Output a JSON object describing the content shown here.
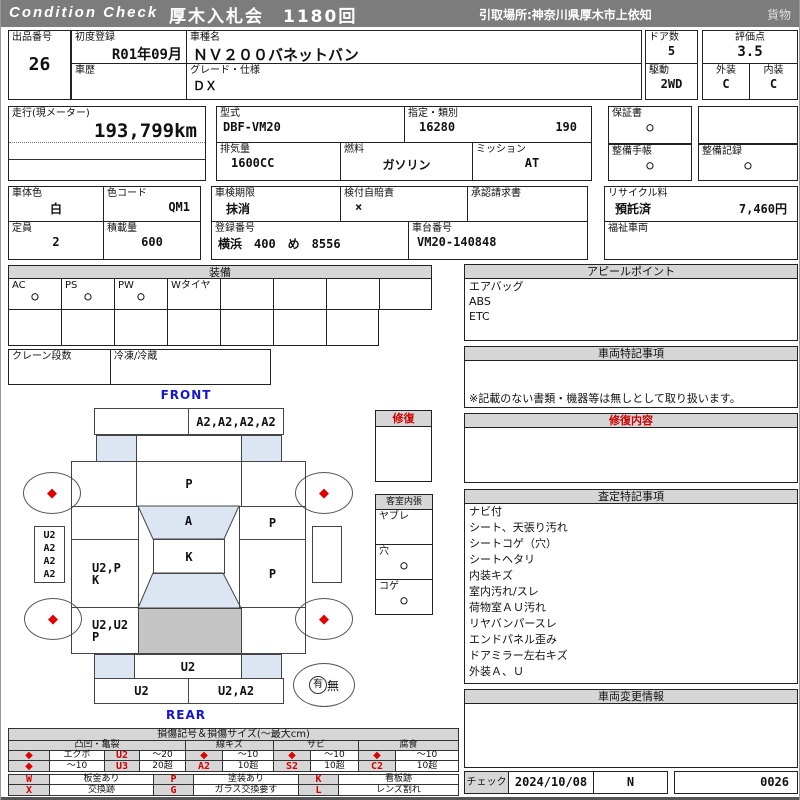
{
  "header": {
    "brand": "Condition Check",
    "title": "厚木入札会　1180回",
    "pickup": "引取場所:神奈川県厚木市上依知",
    "category": "貨物"
  },
  "top": {
    "lot_label": "出品番号",
    "lot_no": "26",
    "first_reg_label": "初度登録",
    "first_reg": "R01年09月",
    "history_label": "車歴",
    "model_name_label": "車種名",
    "model_name": "ＮＶ２００バネットバン",
    "grade_label": "グレード・仕様",
    "grade": "ＤＸ",
    "doors_label": "ドア数",
    "doors": "5",
    "drive_label": "駆動",
    "drive": "2WD",
    "score_label": "評価点",
    "score": "3.5",
    "exterior_label": "外装",
    "exterior": "C",
    "interior_label": "内装",
    "interior": "C"
  },
  "spec": {
    "mileage_label": "走行(現メーター)",
    "mileage": "193,799km",
    "model_code_label": "型式",
    "model_code": "DBF-VM20",
    "class_label": "指定・類別",
    "class_no": "16280",
    "class_no2": "190",
    "warranty_label": "保証書",
    "warranty": "○",
    "displacement_label": "排気量",
    "displacement": "1600CC",
    "fuel_label": "燃料",
    "fuel": "ガソリン",
    "mission_label": "ミッション",
    "mission": "AT",
    "maintenance_book_label": "整備手帳",
    "maintenance_book": "○",
    "maintenance_record_label": "整備記録",
    "maintenance_record": "○",
    "color_label": "車体色",
    "color": "白",
    "color_code_label": "色コード",
    "color_code": "QM1",
    "inspection_label": "車検期限",
    "inspection": "抹消",
    "insurance_label": "検付自賠責",
    "insurance": "×",
    "approval_label": "承認請求書",
    "recycle_label": "リサイクル料",
    "recycle_status": "預託済",
    "recycle_fee": "7,460円",
    "capacity_label": "定員",
    "capacity": "2",
    "load_label": "積載量",
    "load": "600",
    "reg_no_label": "登録番号",
    "reg_no": "横浜　400　め　8556",
    "chassis_label": "車台番号",
    "chassis_no": "VM20-140848",
    "welfare_label": "福祉車両"
  },
  "equipment": {
    "title": "装備",
    "cells": [
      {
        "label": "AC",
        "value": "○"
      },
      {
        "label": "PS",
        "value": "○"
      },
      {
        "label": "PW",
        "value": "○"
      },
      {
        "label": "Wタイヤ",
        "value": ""
      }
    ],
    "crane_label": "クレーン段数",
    "fridge_label": "冷凍/冷蔵"
  },
  "diagram": {
    "front_label": "FRONT",
    "rear_label": "REAR",
    "front_bumper_right": "A2,A2,A2,A2",
    "hood": "P",
    "windshield": "A",
    "roof": "K",
    "right_front": "P",
    "right_mid": "P",
    "left_side_lines": [
      "U2",
      "A2",
      "A2",
      "A2"
    ],
    "left_mid_1": "U2,P",
    "left_mid_2": "K",
    "left_rear_1": "U2,U2",
    "left_rear_2": "P",
    "rear_panel": "U2",
    "rear_bumper_left": "U2",
    "rear_bumper_right": "U2,A2",
    "spare_yes": "有",
    "spare_no": "無",
    "repair_label": "修復",
    "cabin_label": "客室内張",
    "cabin_items": [
      {
        "label": "ヤブレ",
        "value": ""
      },
      {
        "label": "穴",
        "value": "○"
      },
      {
        "label": "コゲ",
        "value": "○"
      }
    ]
  },
  "right": {
    "appeal_title": "アピールポイント",
    "appeal_items": [
      "エアバッグ",
      "ABS",
      "ETC"
    ],
    "notes_title": "車両特記事項",
    "notes_footer": "※記載のない書類・機器等は無しとして取り扱います。",
    "repair_title": "修復内容",
    "assessment_title": "査定特記事項",
    "assessment_items": [
      "ナビ付",
      "シート、天張り汚れ",
      "シートコゲ（穴）",
      "シートヘタリ",
      "内装キズ",
      "室内汚れ/スレ",
      "荷物室ＡＵ汚れ",
      "リヤバンパースレ",
      "エンドパネル歪み",
      "ドアミラー左右キズ",
      "外装Ａ、Ｕ"
    ],
    "change_title": "車両変更情報",
    "check_label": "チェック",
    "check_date": "2024/10/08",
    "check_code": "N",
    "check_no": "0026"
  },
  "legend": {
    "title": "損傷記号＆損傷サイズ(〜最大cm)",
    "groups": [
      "凸凹・亀裂",
      "線キズ",
      "サビ",
      "腐食"
    ],
    "diamond": "◆",
    "g1r1": [
      "エクボ",
      "U2",
      "〜20"
    ],
    "g1r2": [
      "〜10",
      "U3",
      "20超"
    ],
    "g2r1": "〜10",
    "g2r2": [
      "A2",
      "10超"
    ],
    "g3r1": "〜10",
    "g3r2": [
      "S2",
      "10超"
    ],
    "g4r1": "〜10",
    "g4r2": [
      "C2",
      "10超"
    ],
    "marks": [
      [
        "W",
        "板金あり"
      ],
      [
        "P",
        "塗装あり"
      ],
      [
        "K",
        "看板跡"
      ],
      [
        "X",
        "交換跡"
      ],
      [
        "G",
        "ガラス交換要す"
      ],
      [
        "L",
        "レンズ割れ"
      ]
    ]
  }
}
